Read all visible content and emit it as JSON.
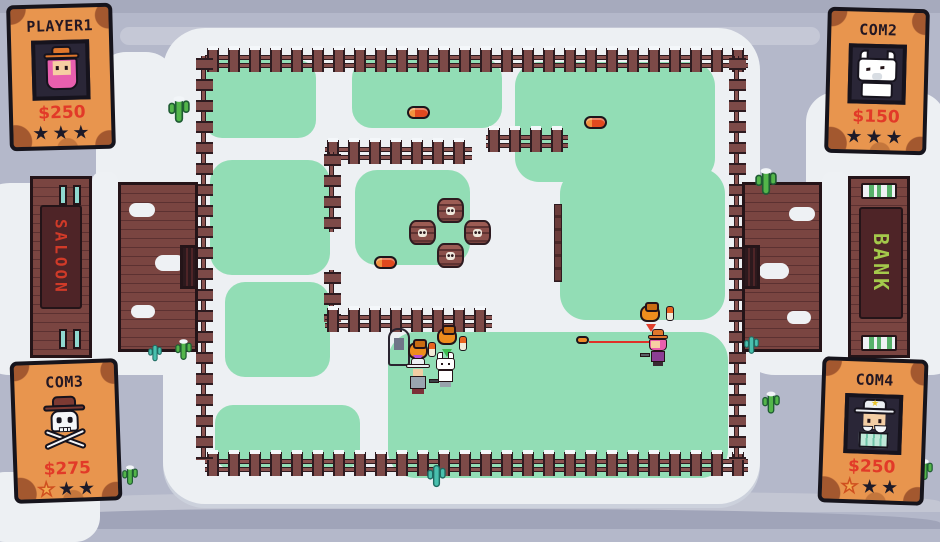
{
  "hud": {
    "players": [
      {
        "name": "PLAYER1",
        "money": "$250",
        "stars": [
          "filled",
          "filled",
          "filled"
        ],
        "portrait": "cowgirl",
        "position": "top-left"
      },
      {
        "name": "COM2",
        "money": "$150",
        "stars": [
          "filled",
          "filled",
          "filled"
        ],
        "portrait": "wolf",
        "position": "top-right"
      },
      {
        "name": "COM3",
        "money": "$275",
        "stars": [
          "lost",
          "filled",
          "filled"
        ],
        "portrait": "skull-and-crossbones",
        "position": "bottom-left"
      },
      {
        "name": "COM4",
        "money": "$250",
        "stars": [
          "lost",
          "filled",
          "filled"
        ],
        "portrait": "gentleman",
        "position": "bottom-right"
      }
    ]
  },
  "world": {
    "buildings": {
      "left": {
        "sign": "SALOON",
        "sign_color": "#d03a28"
      },
      "right": {
        "sign": "BANK",
        "sign_color": "#a4c94b"
      }
    },
    "entities": {
      "barrel_count": 4,
      "ammo_pickup_count": 3,
      "money_bag_count": 3,
      "gravestone_count": 1,
      "characters_on_field": [
        "cowgirl",
        "old-man",
        "wolf"
      ]
    }
  },
  "icons": {
    "star": "★"
  },
  "colors": {
    "background": "#b4b8ca",
    "snow": "#edf0f3",
    "grass": "#92ddb5",
    "fence_wood": "#7d4a48",
    "card_paper": "#e8954e",
    "money_red": "#e23a28",
    "laser_red": "#e03128"
  }
}
